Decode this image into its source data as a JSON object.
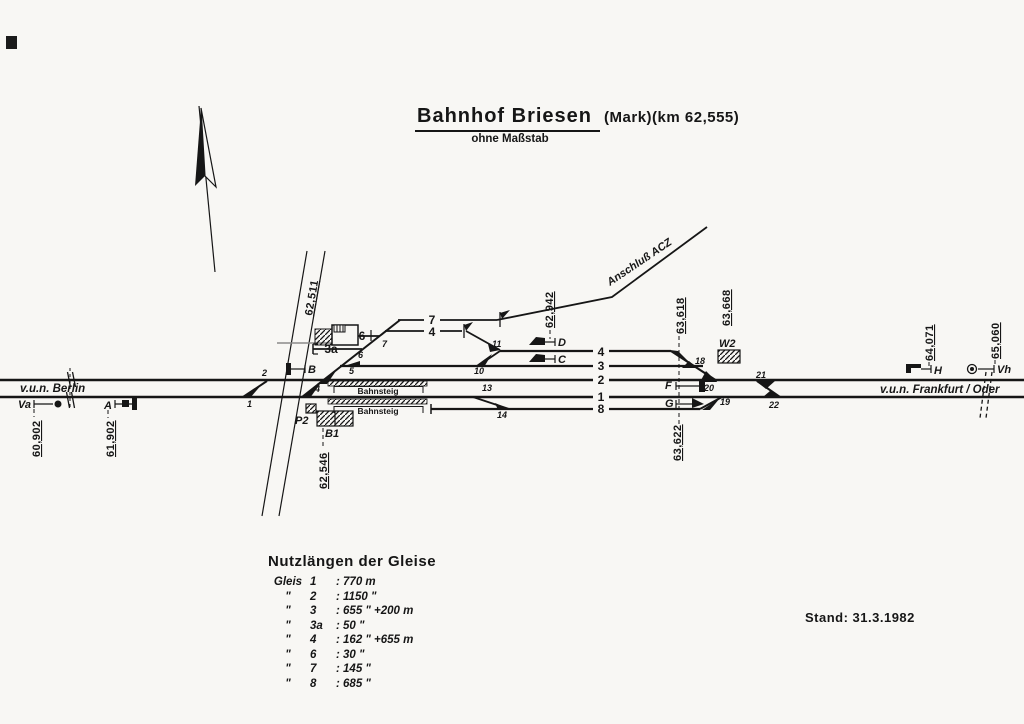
{
  "title": {
    "main": "Bahnhof  Briesen",
    "suffix": "(Mark)(km 62,555)",
    "subtitle": "ohne Maßstab"
  },
  "stand": "Stand: 31.3.1982",
  "directions": {
    "left": "v.u.n. Berlin",
    "right": "v.u.n. Frankfurt / Oder"
  },
  "branch": {
    "label": "Anschluß ACZ"
  },
  "platforms": {
    "label": "Bahnsteig"
  },
  "icons": {
    "north_arrow": "north-arrow",
    "distant_signal": "circle",
    "main_signal": "bar-flag"
  },
  "tracks": {
    "n1": "1",
    "n2": "2",
    "n3": "3",
    "n4": "4",
    "n8": "8",
    "n7": "7",
    "n4_upper": "4",
    "n6": "6",
    "n3a": "3a"
  },
  "switches": {
    "w1": "1",
    "w2": "2",
    "w4": "4",
    "w5": "5",
    "w6": "6",
    "w7": "7",
    "w10": "10",
    "w11": "11",
    "w13": "13",
    "w14": "14",
    "w18": "18",
    "w19": "19",
    "w20": "20",
    "w21": "21",
    "w22": "22"
  },
  "signals": {
    "va": "Va",
    "a": "A",
    "b": "B",
    "c": "C",
    "d": "D",
    "f": "F",
    "g": "G",
    "h": "H",
    "vh": "Vh",
    "p2": "P2"
  },
  "buildings": {
    "b1": "B1",
    "w2": "W2"
  },
  "km": {
    "k60902": "60,902",
    "k61902": "61,902",
    "k62511": "62,511",
    "k62546": "62,546",
    "k62942": "62,942",
    "k63618": "63,618",
    "k63622": "63,622",
    "k63668": "63,668",
    "k64071": "64,071",
    "k65060": "65,060"
  },
  "legend": {
    "title": "Nutzlängen der Gleise",
    "rows": [
      {
        "d": "Gleis",
        "n": "1",
        "v": ": 770 m"
      },
      {
        "d": "\"",
        "n": "2",
        "v": ": 1150 \""
      },
      {
        "d": "\"",
        "n": "3",
        "v": ": 655 \"  +200 m"
      },
      {
        "d": "\"",
        "n": "3a",
        "v": ": 50 \""
      },
      {
        "d": "\"",
        "n": "4",
        "v": ": 162 \"  +655 m"
      },
      {
        "d": "\"",
        "n": "6",
        "v": ": 30 \""
      },
      {
        "d": "\"",
        "n": "7",
        "v": ": 145 \""
      },
      {
        "d": "\"",
        "n": "8",
        "v": ": 685 \""
      }
    ]
  }
}
